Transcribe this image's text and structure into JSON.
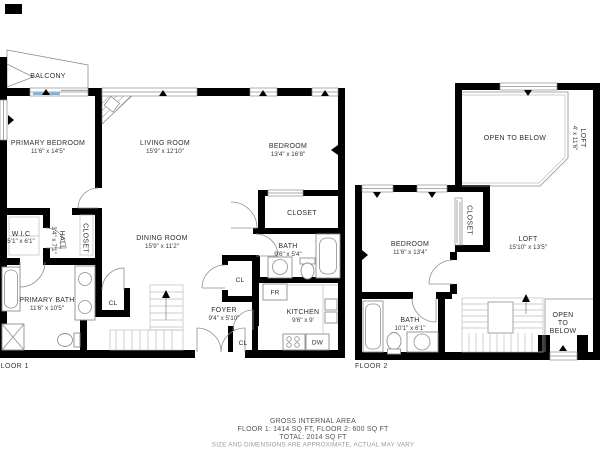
{
  "floor1": {
    "label": "FLOOR 1",
    "balcony": {
      "name": "BALCONY"
    },
    "primary_bedroom": {
      "name": "PRIMARY BEDROOM",
      "dims": "11'6\" x 14'5\""
    },
    "living_room": {
      "name": "LIVING ROOM",
      "dims": "15'9\" x 12'10\""
    },
    "dining_room": {
      "name": "DINING ROOM",
      "dims": "15'9\" x 11'2\""
    },
    "bedroom": {
      "name": "BEDROOM",
      "dims": "13'4\" x 16'8\""
    },
    "bedroom_closet": {
      "name": "CLOSET"
    },
    "wic": {
      "name": "W.I.C",
      "dims": "5'1\" x 6'1\""
    },
    "hall": {
      "name": "HALL",
      "dims": "3'4\" x 7'1\""
    },
    "hall_closet": {
      "name": "CLOSET"
    },
    "primary_bath": {
      "name": "PRIMARY BATH",
      "dims": "11'6\" x 10'5\""
    },
    "bath": {
      "name": "BATH",
      "dims": "9'6\" x 5'4\""
    },
    "kitchen": {
      "name": "KITCHEN",
      "dims": "9'6\" x 9'"
    },
    "foyer": {
      "name": "FOYER",
      "dims": "9'4\" x 5'10\""
    },
    "closet_dining": {
      "name": "CL"
    },
    "closet_upper": {
      "name": "CL"
    },
    "closet_lower": {
      "name": "CL"
    },
    "fridge": {
      "name": "FR"
    },
    "dishwasher": {
      "name": "DW"
    }
  },
  "floor2": {
    "label": "FLOOR 2",
    "open_to_below_top": {
      "name": "OPEN TO BELOW"
    },
    "loft_side": {
      "name": "LOFT",
      "dims": "4' x 11'6\""
    },
    "closet": {
      "name": "CLOSET"
    },
    "bedroom": {
      "name": "BEDROOM",
      "dims": "11'6\" x 13'4\""
    },
    "loft": {
      "name": "LOFT",
      "dims": "15'10\" x 13'5\""
    },
    "bath": {
      "name": "BATH",
      "dims": "10'1\" x 6'1\""
    },
    "open_to_below_bottom": {
      "line1": "OPEN",
      "line2": "TO",
      "line3": "BELOW"
    }
  },
  "footer": {
    "line1": "GROSS INTERNAL AREA",
    "line2": "FLOOR 1: 1414 SQ FT, FLOOR 2: 600 SQ FT",
    "line3": "TOTAL: 2014 SQ FT",
    "line4": "SIZE AND DIMENSIONS ARE APPROXIMATE, ACTUAL MAY VARY"
  },
  "colors": {
    "wall": "#000000",
    "thin_line": "#8e8e8e",
    "text": "#2e2e2e",
    "window_accent": "#7fb2da"
  }
}
